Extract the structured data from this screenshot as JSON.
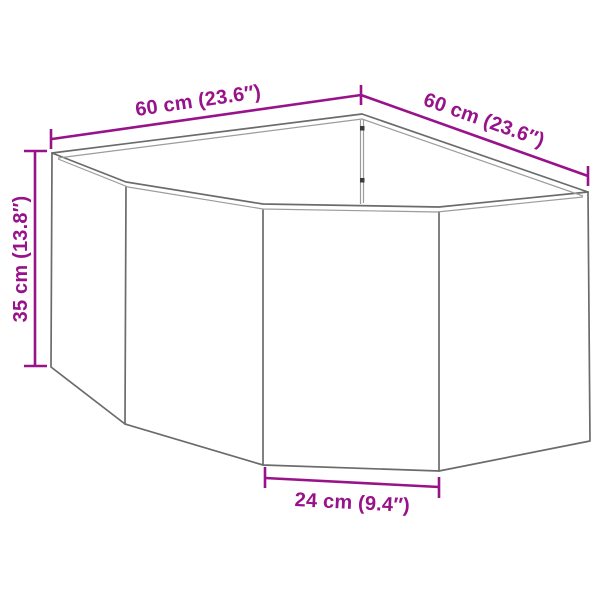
{
  "colors": {
    "dimension_accent": "#98128A",
    "drawing_outline": "#6B6B6B",
    "drawing_inner": "#9C9C9C",
    "seam_dot": "#3A3A3A",
    "background": "#FFFFFF"
  },
  "diagram": {
    "labels": {
      "top_left": "60 cm (23.6″)",
      "top_right": "60 cm (23.6″)",
      "height_left": "35 cm (13.8″)",
      "front_bottom": "24 cm (9.4″)"
    }
  }
}
